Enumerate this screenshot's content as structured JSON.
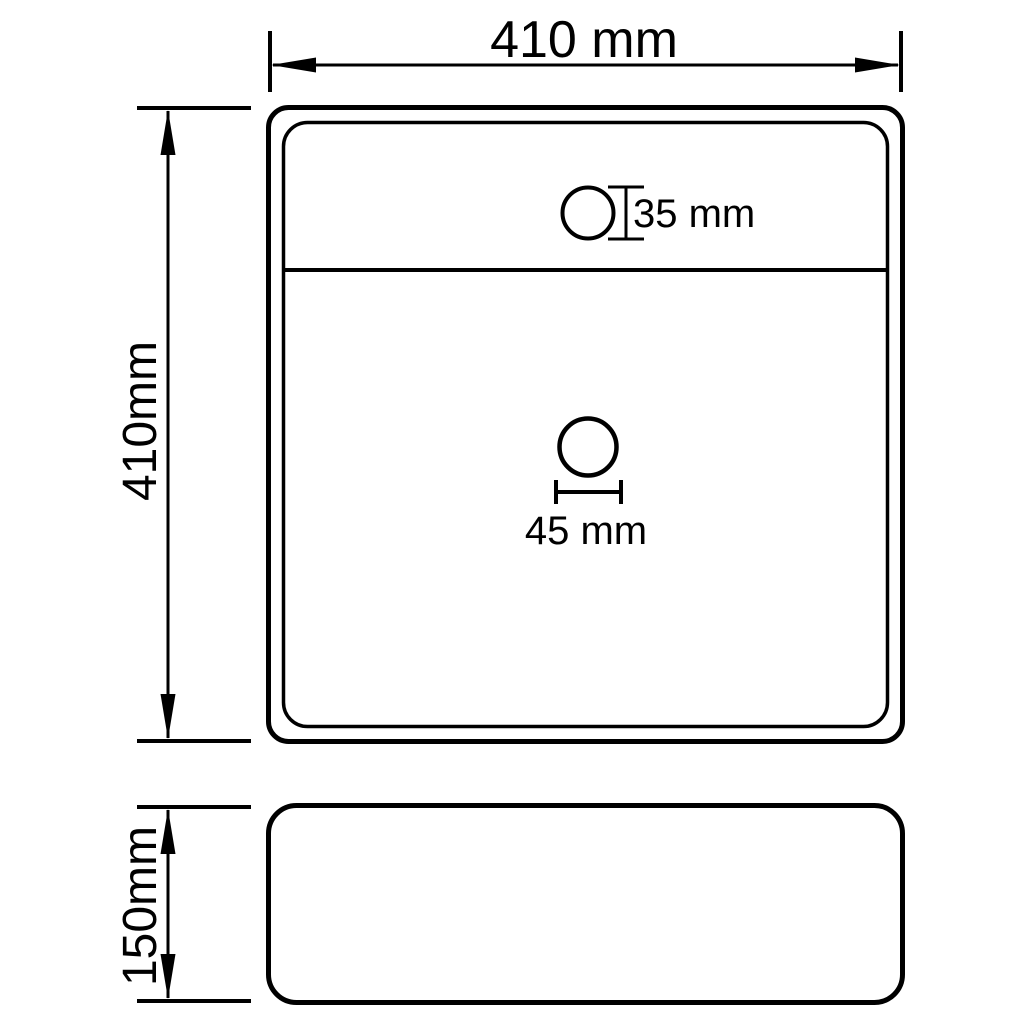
{
  "diagram": {
    "type": "technical-dimension-drawing",
    "units": "mm",
    "line_color": "#000000",
    "background_color": "#ffffff",
    "top_view": {
      "width": {
        "value": 410,
        "label": "410 mm"
      },
      "depth": {
        "value": 410,
        "label": "410mm"
      },
      "faucet_hole_diameter": {
        "value": 35,
        "label": "35 mm"
      },
      "drain_hole_diameter": {
        "value": 45,
        "label": "45 mm"
      }
    },
    "side_view": {
      "height": {
        "value": 150,
        "label": "150mm"
      }
    }
  }
}
